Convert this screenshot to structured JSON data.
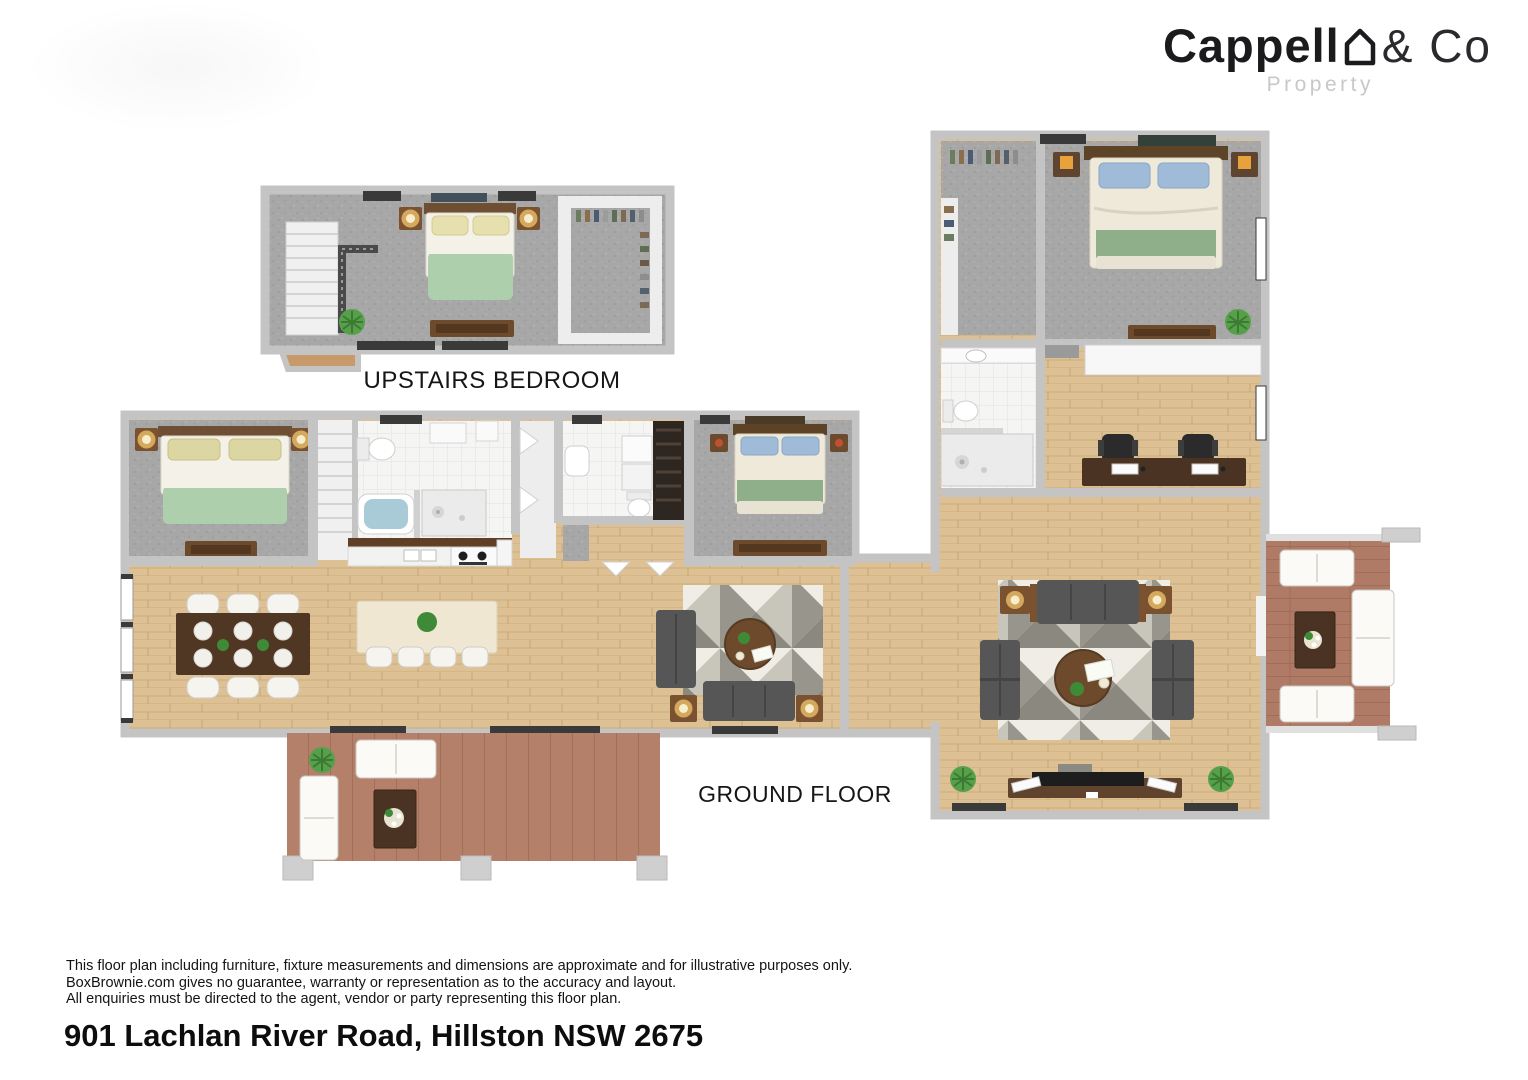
{
  "logo": {
    "brand_bold": "Cappell",
    "brand_light": "& Co",
    "house_icon": "house-outline-icon",
    "subtitle": "Property"
  },
  "floor_labels": {
    "upstairs": "UPSTAIRS BEDROOM",
    "ground": "GROUND FLOOR"
  },
  "disclaimer": {
    "line1": "This floor plan including furniture, fixture measurements and dimensions are approximate and for illustrative purposes only.",
    "line2": "BoxBrownie.com gives no guarantee, warranty or representation as to the accuracy and layout.",
    "line3": "All enquiries must be directed to the agent, vendor or party representing this floor plan."
  },
  "address": "901 Lachlan River Road, Hillston NSW 2675",
  "palette": {
    "logo_text": "#1b1b1e",
    "logo_subtitle": "#c8c8c8",
    "wall": "#c4c4c4",
    "wood_floor": "#ddc195",
    "carpet": "#a7a7a7",
    "deck": "#b5806a",
    "tile": "#f5f5f4",
    "sofa_gray": "#565656",
    "bed_green": "#aecfab",
    "pillow_blue": "#9fbbd8",
    "timber_brown": "#6e4a2d",
    "island_cream": "#efe7d2",
    "bath_water": "#a9cbd8",
    "plant_green": "#57a04a",
    "rug_dark": "#8f8d85",
    "rug_light": "#ece9e0"
  }
}
